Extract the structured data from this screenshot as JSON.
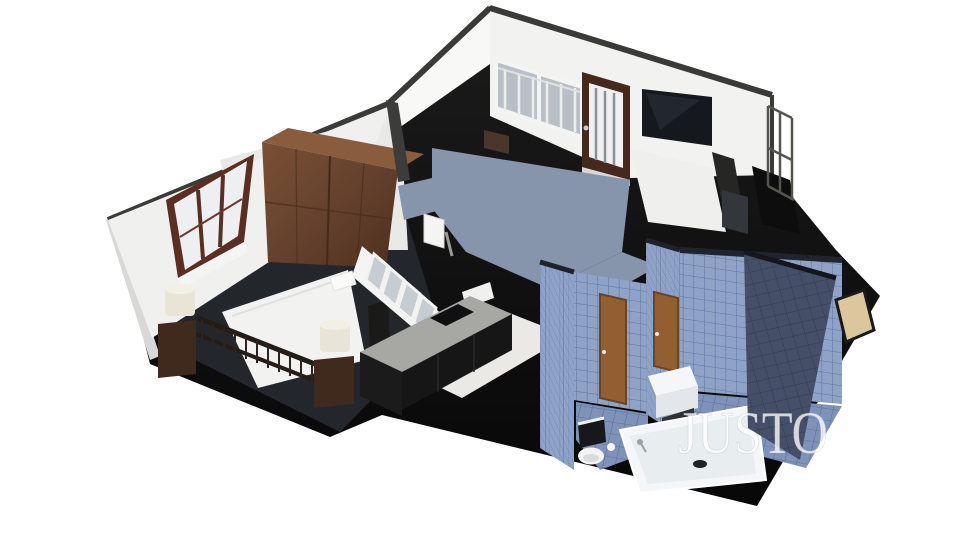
{
  "scene": {
    "type": "3d-floor-plan-render",
    "view": "isometric-cutaway-apartment",
    "background_color": "#ffffff",
    "watermark": {
      "text": "JUSTO",
      "color": "#ffffff",
      "opacity": "0.78"
    },
    "rooms": [
      {
        "id": "bedroom",
        "label": "bedroom",
        "furniture": [
          "double-bed",
          "footboard-railing",
          "wardrobe",
          "nightstand-left",
          "nightstand-right",
          "table-lamp-left",
          "table-lamp-right",
          "window-brown-frame"
        ]
      },
      {
        "id": "living-room",
        "label": "living room",
        "furniture": [
          "wall-tv",
          "balcony-door",
          "window-with-railing",
          "dresser",
          "armchair",
          "floor-cushion"
        ]
      },
      {
        "id": "kitchen",
        "label": "kitchen",
        "furniture": [
          "counter",
          "cooktop",
          "glass-pane-band",
          "range-hood",
          "base-cabinets"
        ]
      },
      {
        "id": "hallway",
        "label": "hallway",
        "furniture": [
          "blue-gray-carpet"
        ]
      },
      {
        "id": "wc",
        "label": "toilet room",
        "furniture": [
          "toilet",
          "oak-door",
          "blue-wall-tiles"
        ]
      },
      {
        "id": "bathroom",
        "label": "bathroom",
        "furniture": [
          "bathtub",
          "washbasin",
          "oak-door",
          "blue-wall-tiles"
        ]
      },
      {
        "id": "balcony",
        "label": "balcony",
        "furniture": [
          "metal-railing"
        ]
      },
      {
        "id": "utility",
        "label": "utility ledge",
        "furniture": [
          "beige-floor-patch"
        ]
      }
    ],
    "palette": {
      "wall_white": "#f2f2f0",
      "wall_cut_dark": "#3c3c3a",
      "slab_black": "#0f0f0f",
      "carpet_blue_gray": "#8695ac",
      "bedroom_floor": "#23272c",
      "kitchen_floor": "#eae9e5",
      "counter_gray": "#a7a7a3",
      "wood_top": "#8a5c3e",
      "window_frame_brown": "#5a2f22",
      "door_brown": "#46281c",
      "bath_door_oak": "#935f31",
      "tile_blue": "#8fa3c7",
      "tile_grout": "#5c74a1",
      "tile_dark": "#454f68",
      "tile_dark_grout": "#333b52",
      "fixture_white": "#f4f6f7",
      "beige_floor": "#dcc69b",
      "lamp_cream": "#e9e5d6",
      "tv_black": "#15181d"
    }
  }
}
